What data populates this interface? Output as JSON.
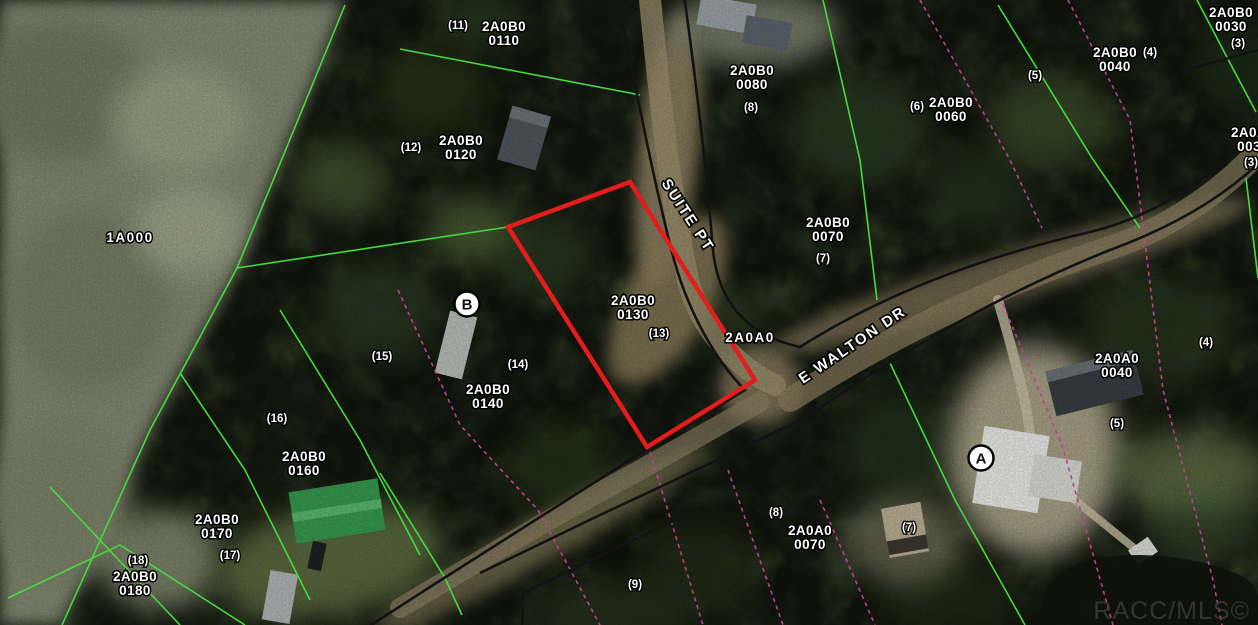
{
  "map": {
    "type": "aerial-parcel-map",
    "attribution": "RACC/MLS©",
    "streets": [
      {
        "name": "SUITE PT"
      },
      {
        "name": "E WALTON DR"
      }
    ],
    "area_labels": [
      {
        "text": "1A000"
      },
      {
        "text": "2A0A0"
      }
    ],
    "markers": [
      {
        "label": "A"
      },
      {
        "label": "B"
      }
    ],
    "subject_parcel": {
      "id": "2A0B0 0130",
      "lot": "(13)",
      "outline_color": "#e31c1c"
    },
    "parcel_labels": [
      {
        "line1": "2A0B0",
        "line2": "0110"
      },
      {
        "line1": "2A0B0",
        "line2": "0120"
      },
      {
        "line1": "2A0B0",
        "line2": "0080"
      },
      {
        "line1": "2A0B0",
        "line2": "0060"
      },
      {
        "line1": "2A0B0",
        "line2": "0030"
      },
      {
        "line1": "2A0B0",
        "line2": "0040"
      },
      {
        "line1": "2A0B0",
        "line2": "0070"
      },
      {
        "line1": "2A0B0",
        "line2": "0130"
      },
      {
        "line1": "2A0B0",
        "line2": "0140"
      },
      {
        "line1": "2A0B0",
        "line2": "0160"
      },
      {
        "line1": "2A0B0",
        "line2": "0170"
      },
      {
        "line1": "2A0B0",
        "line2": "0180"
      },
      {
        "line1": "2A0A0",
        "line2": "0040"
      },
      {
        "line1": "2A0A0",
        "line2": "0070"
      },
      {
        "line1": "2A0A0",
        "line2": "0030"
      }
    ],
    "lot_labels": [
      {
        "text": "(11)"
      },
      {
        "text": "(12)"
      },
      {
        "text": "(8)"
      },
      {
        "text": "(6)"
      },
      {
        "text": "(3)"
      },
      {
        "text": "(4)"
      },
      {
        "text": "(5)"
      },
      {
        "text": "(7)"
      },
      {
        "text": "(13)"
      },
      {
        "text": "(14)"
      },
      {
        "text": "(15)"
      },
      {
        "text": "(16)"
      },
      {
        "text": "(17)"
      },
      {
        "text": "(18)"
      },
      {
        "text": "(4)"
      },
      {
        "text": "(5)"
      },
      {
        "text": "(8)"
      },
      {
        "text": "(7)"
      },
      {
        "text": "(9)"
      },
      {
        "text": "(3)"
      }
    ],
    "colors": {
      "parcel_line": "#46d83f",
      "road_boundary_line": "#121212",
      "easement_line": "#c03f8c",
      "subject_outline": "#e31c1c",
      "label_fill": "#ffffff",
      "label_outline": "#000000"
    }
  }
}
